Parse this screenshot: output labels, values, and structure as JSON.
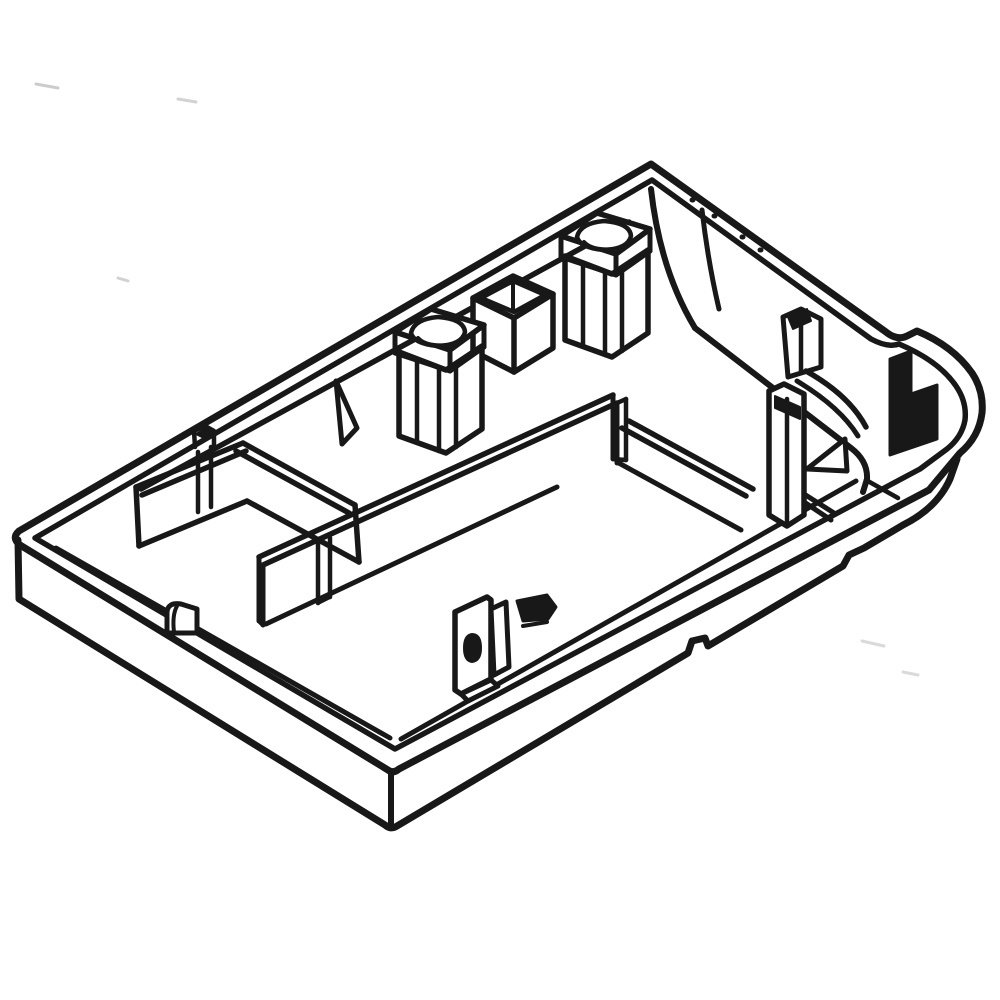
{
  "canvas": {
    "width": 1000,
    "height": 1000,
    "background": "#ffffff",
    "default_stroke": "#181818",
    "default_width": 5.5,
    "speck_color": "#c9c9c9"
  },
  "drawing": {
    "name": "base-pan-isometric-line-art",
    "elements": [
      {
        "name": "scan-speck-1",
        "d": "M 36,84 L 58,88",
        "sw": 3,
        "stroke": "#cccccc"
      },
      {
        "name": "scan-speck-2",
        "d": "M 178,99 L 196,102",
        "sw": 3,
        "stroke": "#d2d2d2"
      },
      {
        "name": "scan-speck-3",
        "d": "M 118,278 L 128,281",
        "sw": 3,
        "stroke": "#d2d2d2"
      },
      {
        "name": "scan-speck-4",
        "d": "M 862,641 L 884,646",
        "sw": 3,
        "stroke": "#dadada"
      },
      {
        "name": "scan-speck-5",
        "d": "M 903,672 L 918,675",
        "sw": 3,
        "stroke": "#dadada"
      },
      {
        "name": "outer-rim",
        "d": "M 651,164 L 886,332 Q 897,341 907,336 L 917,331 Q 953,346 972,373 Q 984,391 982,413 Q 979,437 960,453 L 929,490 L 399,769 Q 393,774 388,770 L 20,545 Q 11,538 19,531 Z",
        "sw": 7,
        "fill": "#ffffff"
      },
      {
        "name": "inner-rim",
        "d": "M 652,180 L 871,339 Q 888,348 899,344 Q 939,361 956,386 Q 967,402 965,420 Q 962,437 947,449 L 920,469 L 395,749 L 35,538 Z",
        "sw": 5.5
      },
      {
        "name": "rim-dot-1",
        "d": "M 692,200 L 693,200",
        "sw": 5
      },
      {
        "name": "rim-dot-2",
        "d": "M 714,216 L 715,216",
        "sw": 5
      },
      {
        "name": "rim-dot-3",
        "d": "M 742,237 L 743,237",
        "sw": 5
      },
      {
        "name": "rim-dot-4",
        "d": "M 760,250 L 761,250",
        "sw": 5
      },
      {
        "name": "floor-junction-topleft-wall",
        "d": "M 629,222 L 141,489",
        "sw": 5.5
      },
      {
        "name": "apex-corner-fillet-outer",
        "d": "M 651,189 Q 660,270 695,328",
        "sw": 6
      },
      {
        "name": "apex-corner-fillet-inner",
        "d": "M 702,210 Q 708,262 719,309",
        "sw": 5
      },
      {
        "name": "floor-junction-topright-wall",
        "d": "M 695,328 L 851,448 Q 868,461 867,479 L 863,492",
        "sw": 6
      },
      {
        "name": "floor-junction-bottomleft-wall",
        "d": "M 56,548 L 390,738",
        "sw": 5
      },
      {
        "name": "floor-junction-bottomright-wall",
        "d": "M 401,739 L 856,481",
        "sw": 5
      },
      {
        "name": "left-box-far-wall-top-outer",
        "d": "M 136,487 L 243,443",
        "sw": 5.5
      },
      {
        "name": "left-box-far-wall-top-inner",
        "d": "M 142,495 L 246,451",
        "sw": 5.5
      },
      {
        "name": "left-box-far-wall-left-end",
        "d": "M 136,487 L 139,546",
        "sw": 5.5
      },
      {
        "name": "left-box-far-wall-bottom",
        "d": "M 139,546 L 247,501",
        "sw": 5.5
      },
      {
        "name": "left-box-right-wall-top-outer",
        "d": "M 243,443 L 355,505",
        "sw": 5.5
      },
      {
        "name": "left-box-right-wall-top-inner",
        "d": "M 236,451 L 349,513",
        "sw": 5.5
      },
      {
        "name": "left-box-right-wall-bottom",
        "d": "M 247,501 L 359,562",
        "sw": 5.5
      },
      {
        "name": "left-box-right-wall-end",
        "d": "M 355,505 L 359,562",
        "sw": 5.5
      },
      {
        "name": "left-box-rib-left",
        "d": "M 198,452 L 198,512",
        "sw": 4.5
      },
      {
        "name": "left-box-rib-right",
        "d": "M 211,447 L 211,507",
        "sw": 4.5
      },
      {
        "name": "left-box-rib-tab",
        "d": "M 195,447 L 194,431 L 205,426 L 214,431 L 214,446",
        "sw": 4.5
      },
      {
        "name": "left-box-rib-tab-cap",
        "d": "M 196,434 L 205,429 L 213,434 L 204,438 Z",
        "sw": 2,
        "fill": "#181818"
      },
      {
        "name": "central-partition-top-near",
        "d": "M 263,565 L 617,403",
        "sw": 5.5
      },
      {
        "name": "central-partition-top-far",
        "d": "M 259,557 L 613,395",
        "sw": 5.5
      },
      {
        "name": "central-partition-left-end-a",
        "d": "M 259,557 L 259,621",
        "sw": 5
      },
      {
        "name": "central-partition-left-end-b",
        "d": "M 263,565 L 263,625",
        "sw": 5
      },
      {
        "name": "central-partition-left-end-bottom",
        "d": "M 259,621 L 263,625",
        "sw": 4.5
      },
      {
        "name": "central-partition-face-bottom",
        "d": "M 266,624 L 557,487",
        "sw": 5
      },
      {
        "name": "central-partition-right-end-a",
        "d": "M 613,395 L 613,459",
        "sw": 5
      },
      {
        "name": "central-partition-right-end-b",
        "d": "M 617,403 L 617,463",
        "sw": 5
      },
      {
        "name": "central-partition-right-end-c",
        "d": "M 626,399 L 626,460",
        "sw": 4.5
      },
      {
        "name": "central-partition-right-end-top",
        "d": "M 617,403 L 626,399",
        "sw": 4.5
      },
      {
        "name": "central-partition-right-end-bottom",
        "d": "M 613,459 L 626,460",
        "sw": 4.5
      },
      {
        "name": "central-partition-rib-left",
        "d": "M 318,544 L 318,603",
        "sw": 4.5
      },
      {
        "name": "central-partition-rib-right",
        "d": "M 330,538 L 330,597",
        "sw": 4.5
      },
      {
        "name": "central-partition-rib-bottom",
        "d": "M 318,603 L 330,597",
        "sw": 4
      },
      {
        "name": "gusset-rib-left",
        "d": "M 336,381 L 357,428 L 342,444 Z",
        "sw": 5,
        "fill": "#ffffff"
      },
      {
        "name": "sleeve-body",
        "d": "M 473,298 L 513,276 L 553,294 L 553,348 L 514,372 L 473,351 Z",
        "sw": 5.5,
        "fill": "#ffffff"
      },
      {
        "name": "sleeve-top-front-edges",
        "d": "M 473,298 L 514,318 L 553,294",
        "sw": 5.5
      },
      {
        "name": "sleeve-top-inner-ring",
        "d": "M 481,298 L 513,281 L 545,295 L 514,312 Z",
        "sw": 4.5
      },
      {
        "name": "sleeve-front-corner-edge",
        "d": "M 514,318 L 514,372",
        "sw": 5.5
      },
      {
        "name": "sleeve-inner-back-edge",
        "d": "M 513,281 L 513,311",
        "sw": 4
      },
      {
        "name": "screw-boss-a-body",
        "d": "M 399,352 L 446,370 L 482,346 L 482,429 L 446,453 L 399,436 Z",
        "sw": 5.5,
        "fill": "#ffffff"
      },
      {
        "name": "screw-boss-a-edge-1",
        "d": "M 417,359 L 417,442",
        "sw": 4.5
      },
      {
        "name": "screw-boss-a-edge-2",
        "d": "M 439,367 L 439,451",
        "sw": 4.5
      },
      {
        "name": "screw-boss-a-edge-3",
        "d": "M 456,363 L 456,447",
        "sw": 4.5
      },
      {
        "name": "screw-boss-a-collar",
        "d": "M 395,332 L 431,309 L 484,325 L 450,350 Z",
        "sw": 5.5,
        "fill": "#ffffff"
      },
      {
        "name": "screw-boss-a-collar-left",
        "d": "M 395,332 L 395,353",
        "sw": 5
      },
      {
        "name": "screw-boss-a-collar-mid",
        "d": "M 450,350 L 450,371",
        "sw": 5
      },
      {
        "name": "screw-boss-a-collar-right",
        "d": "M 484,325 L 484,347",
        "sw": 5
      },
      {
        "name": "screw-boss-a-collar-bottom",
        "d": "M 395,353 L 450,371 L 484,347",
        "sw": 5
      },
      {
        "name": "screw-boss-a-bore",
        "d": "M 411,333 Q 414,319 438,317 Q 464,319 465,332 Q 462,345 438,346 Q 414,344 411,333 Z",
        "sw": 4.5,
        "fill": "#ffffff"
      },
      {
        "name": "screw-boss-a-bore-depth",
        "d": "M 418,338 Q 426,347 448,345",
        "sw": 4
      },
      {
        "name": "screw-boss-b-body",
        "d": "M 565,256 L 612,274 L 648,250 L 648,333 L 612,357 L 565,340 Z",
        "sw": 5.5,
        "fill": "#ffffff"
      },
      {
        "name": "screw-boss-b-edge-1",
        "d": "M 583,263 L 583,346",
        "sw": 4.5
      },
      {
        "name": "screw-boss-b-edge-2",
        "d": "M 605,271 L 605,355",
        "sw": 4.5
      },
      {
        "name": "screw-boss-b-edge-3",
        "d": "M 622,267 L 622,351",
        "sw": 4.5
      },
      {
        "name": "screw-boss-b-collar",
        "d": "M 561,236 L 597,213 L 650,229 L 616,254 Z",
        "sw": 5.5,
        "fill": "#ffffff"
      },
      {
        "name": "screw-boss-b-collar-left",
        "d": "M 561,236 L 561,257",
        "sw": 5
      },
      {
        "name": "screw-boss-b-collar-mid",
        "d": "M 616,254 L 616,275",
        "sw": 5
      },
      {
        "name": "screw-boss-b-collar-right",
        "d": "M 650,229 L 650,251",
        "sw": 5
      },
      {
        "name": "screw-boss-b-collar-bottom",
        "d": "M 561,257 L 616,275 L 650,251",
        "sw": 5
      },
      {
        "name": "screw-boss-b-bore",
        "d": "M 577,237 Q 580,223 604,221 Q 630,223 631,236 Q 628,249 604,250 Q 580,248 577,237 Z",
        "sw": 4.5,
        "fill": "#ffffff"
      },
      {
        "name": "screw-boss-b-bore-depth",
        "d": "M 584,242 Q 592,251 614,249",
        "sw": 4
      },
      {
        "name": "transverse-wall-top-a",
        "d": "M 629,421 L 753,489",
        "sw": 5.5
      },
      {
        "name": "transverse-wall-top-b",
        "d": "M 622,428 L 746,496",
        "sw": 5.5
      },
      {
        "name": "transverse-wall-bottom",
        "d": "M 617,462 L 741,530",
        "sw": 5
      },
      {
        "name": "transverse-post",
        "d": "M 769,391 L 784,384 L 804,394 L 804,515 L 787,526 L 769,515 Z",
        "sw": 5.5,
        "fill": "#ffffff"
      },
      {
        "name": "transverse-post-edge",
        "d": "M 787,399 L 787,524",
        "sw": 4.5
      },
      {
        "name": "transverse-post-head-clip",
        "d": "M 775,396 L 800,407 L 800,419 L 775,408 Z",
        "sw": 2,
        "fill": "#181818"
      },
      {
        "name": "transverse-wall-cont-a",
        "d": "M 804,494 L 834,513",
        "sw": 5
      },
      {
        "name": "transverse-wall-cont-b",
        "d": "M 804,502 L 831,520",
        "sw": 5
      },
      {
        "name": "corner-tab",
        "d": "M 783,317 L 801,309 L 821,319 L 821,367 L 788,377 Z",
        "sw": 5,
        "fill": "#ffffff"
      },
      {
        "name": "corner-tab-edge",
        "d": "M 801,313 L 801,371",
        "sw": 4.5
      },
      {
        "name": "corner-tab-clip",
        "d": "M 788,317 L 807,309 L 811,321 L 793,329 Z",
        "sw": 2,
        "fill": "#181818"
      },
      {
        "name": "corner-curved-wall-a",
        "d": "M 806,371 Q 849,395 866,427",
        "sw": 5.5
      },
      {
        "name": "corner-curved-wall-b",
        "d": "M 797,381 Q 840,407 858,436",
        "sw": 5
      },
      {
        "name": "corner-latch-tab",
        "d": "M 890,359 L 911,351 L 911,394 L 937,385 L 937,439 L 890,455 Z",
        "sw": 3,
        "fill": "#181818"
      },
      {
        "name": "corner-gusset",
        "d": "M 807,469 L 845,439 L 847,471 Z",
        "sw": 5,
        "fill": "#ffffff"
      },
      {
        "name": "corner-step-line",
        "d": "M 866,480 L 898,498",
        "sw": 4.5
      },
      {
        "name": "bracket-plate",
        "d": "M 455,612 L 487,597 L 491,600 L 491,679 L 461,694 L 455,690 Z",
        "sw": 5.5,
        "fill": "#ffffff"
      },
      {
        "name": "bracket-hole",
        "d": "M 472,634 Q 481,634 481,648 Q 481,661 472,662 Q 464,661 464,648 Q 464,635 472,634 Z",
        "sw": 2,
        "fill": "#181818"
      },
      {
        "name": "bracket-side",
        "d": "M 491,609 L 506,602 L 509,667 L 494,675 Z",
        "sw": 5,
        "fill": "#ffffff"
      },
      {
        "name": "bracket-foot",
        "d": "M 461,694 L 491,680 L 498,686 L 468,701 Z",
        "sw": 5,
        "fill": "#ffffff"
      },
      {
        "name": "bracket-clip",
        "d": "M 517,601 L 547,595 L 556,607 L 548,619 L 523,621 Z",
        "sw": 3,
        "fill": "#181818"
      },
      {
        "name": "bracket-clip-under",
        "d": "M 523,626 L 547,622",
        "sw": 4
      },
      {
        "name": "floor-bump",
        "d": "M 167,633 L 167,612 Q 168,602 181,604 L 197,609 L 197,633 Z",
        "sw": 5,
        "fill": "#ffffff"
      },
      {
        "name": "floor-bump-inner",
        "d": "M 177,606 Q 172,615 174,632",
        "sw": 4
      },
      {
        "name": "outer-wall-bottom-edge",
        "d": "M 18,540 L 19,599 L 385,825 Q 391,830 397,826 L 688,653 L 692,641 L 705,638 L 708,646 L 843,566 L 849,555 L 864,548 L 903,525 Q 937,508 950,479 L 957,459",
        "sw": 7
      },
      {
        "name": "bottom-corner-edge",
        "d": "M 391,774 L 391,828",
        "sw": 6
      }
    ]
  }
}
